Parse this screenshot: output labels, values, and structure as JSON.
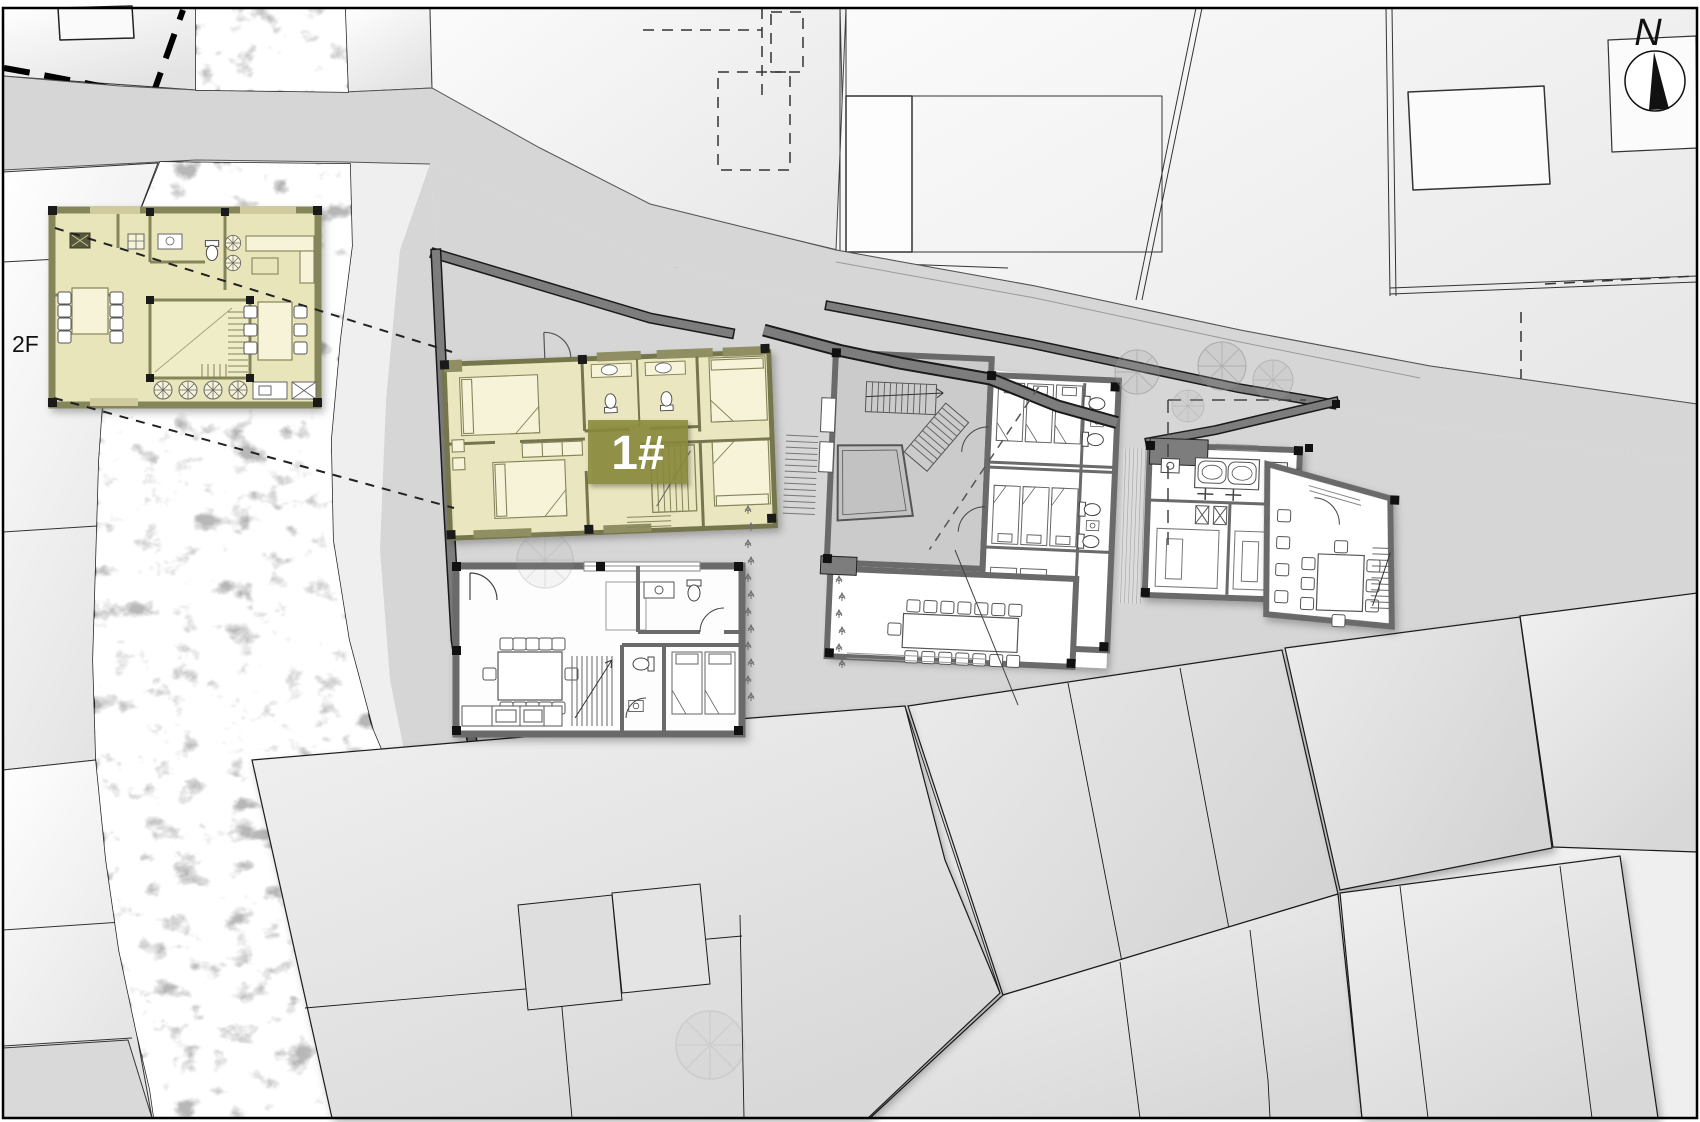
{
  "title": "Architectural site plan with highlighted guesthouse unit",
  "labels": {
    "floor_callout": "2F",
    "highlighted_building": "1#",
    "north": "N"
  },
  "colors": {
    "highlight_fill": "#ece8bf",
    "highlight_wall": "#76764e",
    "highlight_label_bg": "#8a8a3c",
    "label_text": "#ffffff",
    "water": "#b7b7b7",
    "road": "#d6d6d6",
    "site_wall": "#7d7d7d",
    "parcel": "#f4f4f4",
    "roof": "#e7e7e7",
    "line": "#1a1a1a"
  }
}
